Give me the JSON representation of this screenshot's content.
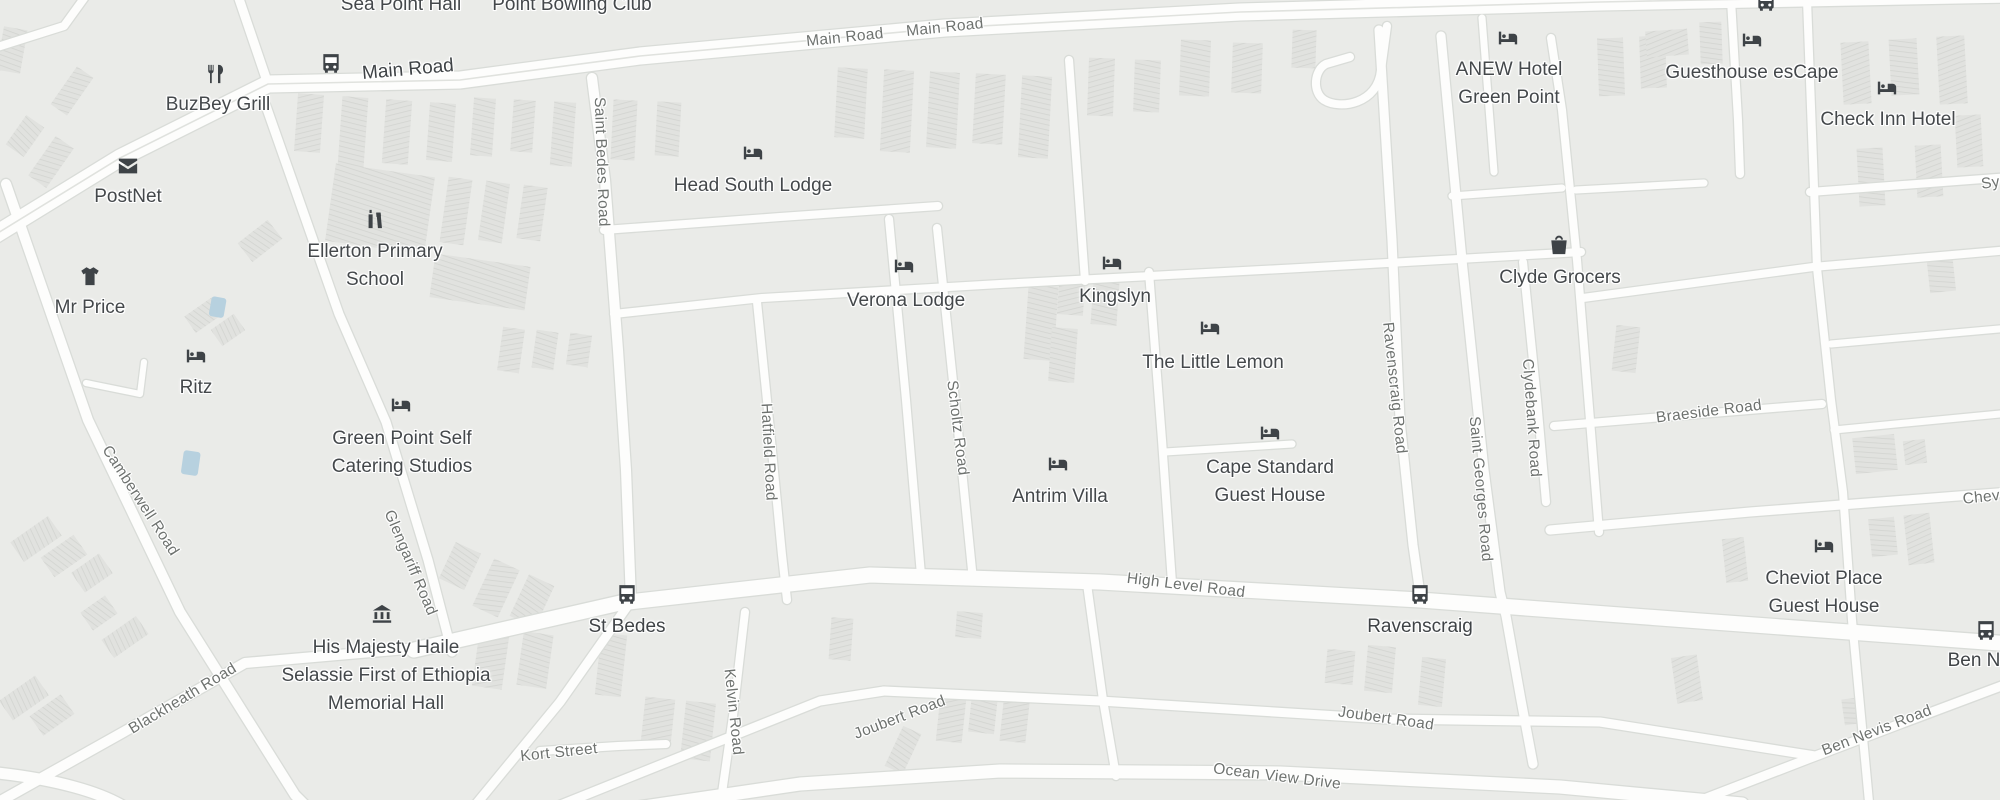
{
  "map": {
    "pois": [
      {
        "id": "sea-point-hall",
        "name": "Sea Point Hall"
      },
      {
        "id": "point-bowling-club",
        "name": "Point Bowling Club"
      },
      {
        "id": "buzbey-grill",
        "name": "BuzBey Grill",
        "icon": "restaurant-icon"
      },
      {
        "id": "postnet",
        "name": "PostNet",
        "icon": "mail-icon"
      },
      {
        "id": "mr-price",
        "name": "Mr Price",
        "icon": "clothing-icon"
      },
      {
        "id": "ritz",
        "name": "Ritz",
        "icon": "lodging-icon"
      },
      {
        "id": "ellerton-primary-school",
        "lines": [
          "Ellerton Primary",
          "School"
        ],
        "icon": "school-icon"
      },
      {
        "id": "green-point-self-catering-studios",
        "lines": [
          "Green Point Self",
          "Catering Studios"
        ],
        "icon": "lodging-icon"
      },
      {
        "id": "head-south-lodge",
        "name": "Head South Lodge",
        "icon": "lodging-icon"
      },
      {
        "id": "verona-lodge",
        "name": "Verona Lodge",
        "icon": "lodging-icon"
      },
      {
        "id": "kingslyn",
        "name": "Kingslyn",
        "icon": "lodging-icon"
      },
      {
        "id": "the-little-lemon",
        "name": "The Little Lemon",
        "icon": "lodging-icon"
      },
      {
        "id": "cape-standard-guest-house",
        "lines": [
          "Cape Standard",
          "Guest House"
        ],
        "icon": "lodging-icon"
      },
      {
        "id": "antrim-villa",
        "name": "Antrim Villa",
        "icon": "lodging-icon"
      },
      {
        "id": "clyde-grocers",
        "name": "Clyde Grocers",
        "icon": "grocery-icon"
      },
      {
        "id": "anew-hotel-green-point",
        "lines": [
          "ANEW Hotel",
          "Green Point"
        ],
        "icon": "lodging-icon"
      },
      {
        "id": "guesthouse-escape",
        "name": "Guesthouse esCape",
        "icon": "lodging-icon"
      },
      {
        "id": "check-inn-hotel",
        "name": "Check Inn Hotel",
        "icon": "lodging-icon"
      },
      {
        "id": "cheviot-place-guest-house",
        "lines": [
          "Cheviot Place",
          "Guest House"
        ],
        "icon": "lodging-icon"
      },
      {
        "id": "haile-selassie-memorial-hall",
        "lines": [
          "His Majesty Haile",
          "Selassie First of Ethiopia",
          "Memorial Hall"
        ],
        "icon": "museum-icon"
      }
    ],
    "transit_stops": [
      {
        "id": "main-road-stop",
        "name": "Main Road"
      },
      {
        "id": "st-bedes-stop",
        "name": "St Bedes"
      },
      {
        "id": "ravenscraig-stop",
        "name": "Ravenscraig"
      },
      {
        "id": "ben-nevis-stop",
        "name": "Ben N"
      },
      {
        "id": "top-right-stop",
        "name": ""
      }
    ],
    "road_labels": [
      {
        "id": "main-road-1",
        "name": "Main Road"
      },
      {
        "id": "main-road-2",
        "name": "Main Road"
      },
      {
        "id": "saint-bedes-road",
        "name": "Saint Bedes Road"
      },
      {
        "id": "hatfield-road",
        "name": "Hatfield Road"
      },
      {
        "id": "scholtz-road",
        "name": "Scholtz Road"
      },
      {
        "id": "kelvin-road",
        "name": "Kelvin Road"
      },
      {
        "id": "camberwell-road",
        "name": "Camberwell Road"
      },
      {
        "id": "blackheath-road",
        "name": "Blackheath Road"
      },
      {
        "id": "glengariff-road",
        "name": "Glengariff Road"
      },
      {
        "id": "kort-street",
        "name": "Kort Street"
      },
      {
        "id": "high-level-road",
        "name": "High Level Road"
      },
      {
        "id": "joubert-road-west",
        "name": "Joubert Road"
      },
      {
        "id": "joubert-road-east",
        "name": "Joubert Road"
      },
      {
        "id": "ocean-view-drive",
        "name": "Ocean View Drive"
      },
      {
        "id": "ben-nevis-road",
        "name": "Ben Nevis Road"
      },
      {
        "id": "ravenscraig-road",
        "name": "Ravenscraig Road"
      },
      {
        "id": "saint-georges-road",
        "name": "Saint Georges Road"
      },
      {
        "id": "clydebank-road",
        "name": "Clydebank Road"
      },
      {
        "id": "braeside-road",
        "name": "Braeside Road"
      },
      {
        "id": "cheviot-road-partial",
        "name": "Cheviot"
      },
      {
        "id": "sydney-road-partial",
        "name": "Syd"
      }
    ],
    "colors": {
      "background": "#eaebe8",
      "road": "#fdfdfc",
      "road_casing": "#d9dcd8",
      "building": "#e1e2df",
      "building_hatch": "#d2d4d0",
      "poi_text": "#44484b",
      "road_text": "#6e726f",
      "icon": "#3e4347",
      "water": "#b7d1df"
    }
  }
}
